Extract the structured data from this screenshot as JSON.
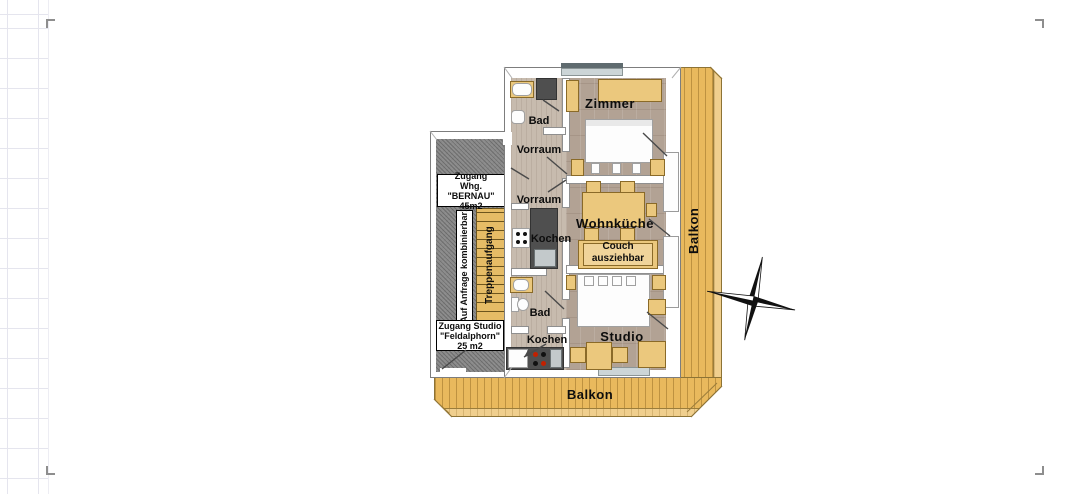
{
  "floorplan": {
    "rooms": {
      "zimmer": "Zimmer",
      "wohnkueche": "Wohnküche",
      "studio": "Studio",
      "bad_top": "Bad",
      "bad_bottom": "Bad",
      "vorraum_top": "Vorraum",
      "vorraum_mid": "Vorraum",
      "kochen_top": "Kochen",
      "kochen_bottom": "Kochen",
      "treppenaufgang": "Treppenaufgang",
      "balkon_right": "Balkon",
      "balkon_bottom": "Balkon",
      "couch": [
        "Couch",
        "ausziehbar"
      ]
    },
    "unit_notes": {
      "bernau": [
        "Zugang",
        "Whg. \"BERNAU\"",
        "45m2"
      ],
      "feldalphorn": [
        "Zugang Studio",
        "\"Feldalphorn\"",
        "25 m2"
      ],
      "kombinierbar": "Auf Anfrage kombinierbar!"
    },
    "colors": {
      "balcony_wood": "#e9b95d",
      "room_floor": "#b2a294",
      "corridor_floor": "#c7bbae",
      "stair_wood": "#e6bc66",
      "furniture_wood": "#ebc87d",
      "landing_gray": "#8d8d8d",
      "kitchen_counter": "#4f4f4f",
      "window_glass": "#ccd5d7"
    }
  }
}
